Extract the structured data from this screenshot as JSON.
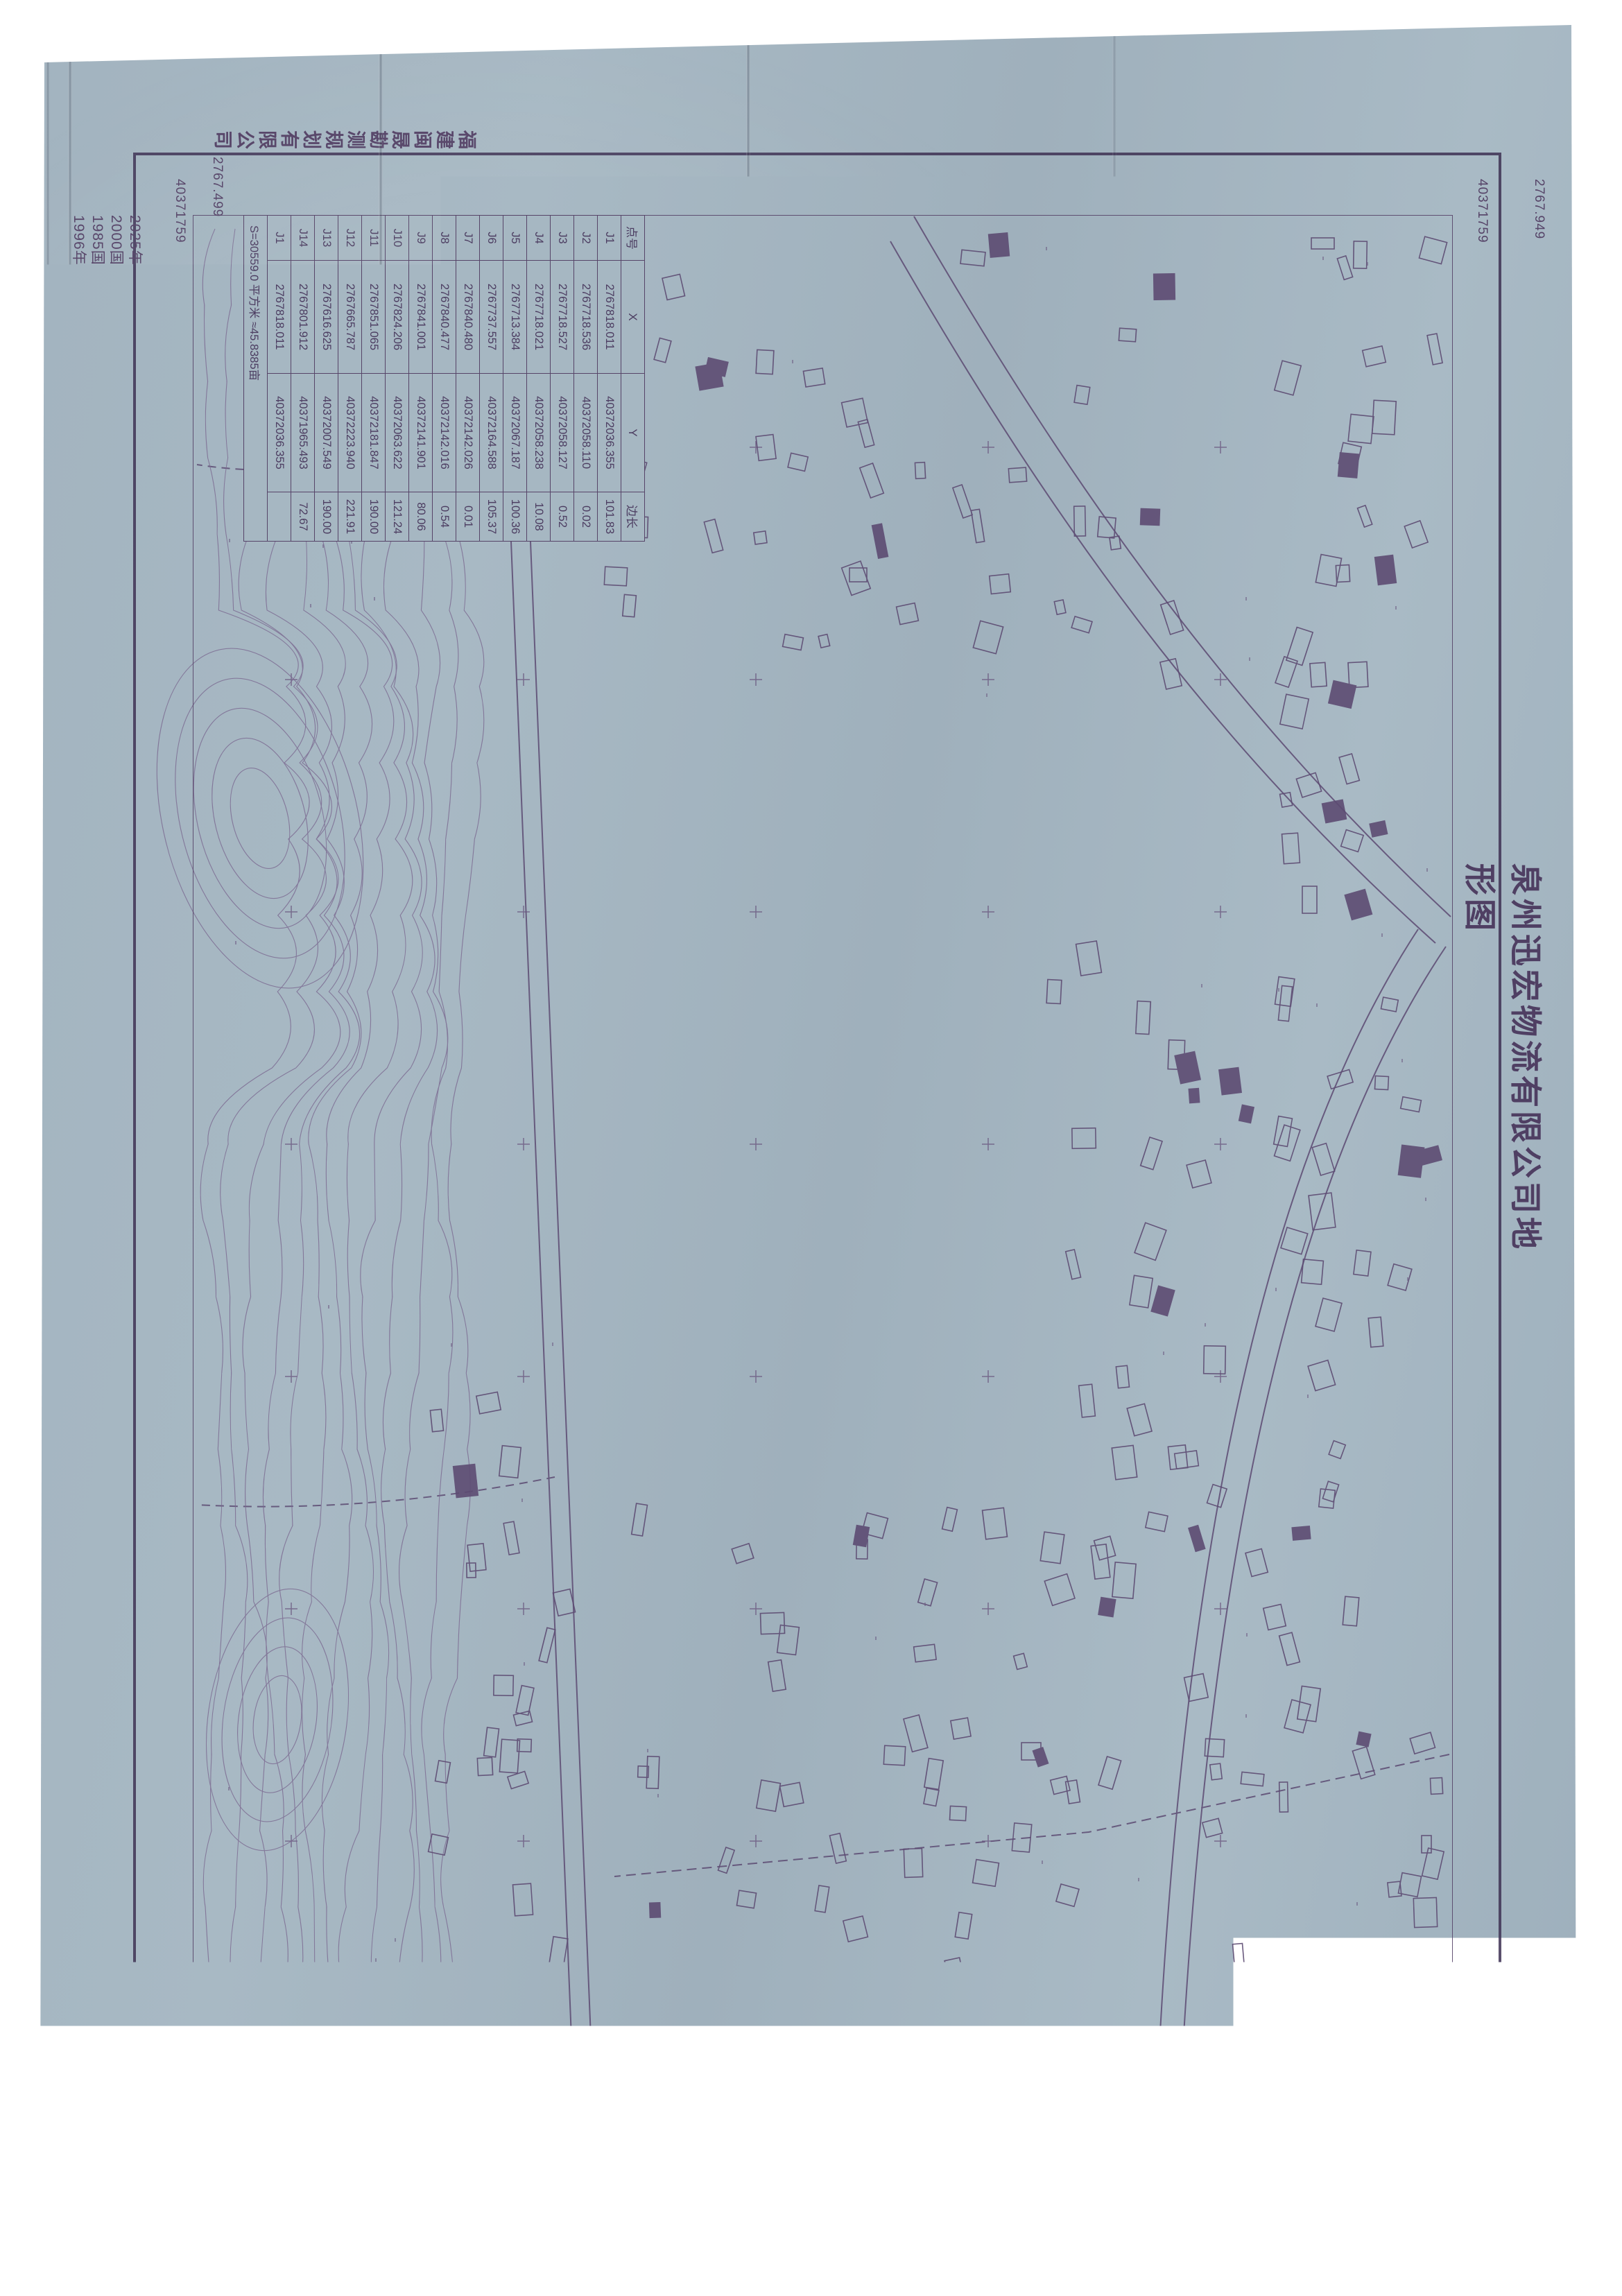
{
  "colors": {
    "paper": "#a6b7c2",
    "ink": "#564468",
    "ink_dark": "#3e3153",
    "red": "#c23a2f",
    "title": "#4f3f63",
    "watermark_text": "#16273c",
    "cs_blue": "#1f66d6"
  },
  "title": "泉州迅宏物流有限公司地形图",
  "surveyor_company": "福建闽晟勘测规划有限公司",
  "notes": [
    "2025年8月数字化制图，",
    "2000国家大地坐标系，中央子午线120度。",
    "1985国家高程基准，等高距为1.0米。",
    "1996年版图式。"
  ],
  "scale_label": "1:1500",
  "corner_labels": {
    "top_northing": "2767.949",
    "top_easting": "40371759",
    "bottom_northing": "2767.499",
    "bottom_easting": "40371759"
  },
  "road_label": "(X308)",
  "boundary_table": {
    "headers": [
      "点号",
      "X",
      "Y",
      "边长"
    ],
    "rows": [
      [
        "J1",
        "2767818.011",
        "40372036.355",
        "101.83"
      ],
      [
        "J2",
        "2767718.536",
        "40372058.110",
        "0.02"
      ],
      [
        "J3",
        "2767718.527",
        "40372058.127",
        "0.52"
      ],
      [
        "J4",
        "2767718.021",
        "40372058.238",
        "10.08"
      ],
      [
        "J5",
        "2767713.384",
        "40372067.187",
        "100.36"
      ],
      [
        "J6",
        "2767737.557",
        "40372164.588",
        "105.37"
      ],
      [
        "J7",
        "2767840.480",
        "40372142.026",
        "0.01"
      ],
      [
        "J8",
        "2767840.477",
        "40372142.016",
        "0.54"
      ],
      [
        "J9",
        "2767841.001",
        "40372141.901",
        "80.06"
      ],
      [
        "J10",
        "2767824.206",
        "40372063.622",
        "121.24"
      ],
      [
        "J11",
        "2767851.065",
        "40372181.847",
        "190.00"
      ],
      [
        "J12",
        "2767665.787",
        "40372223.940",
        "221.91"
      ],
      [
        "J13",
        "2767616.625",
        "40372007.549",
        "190.00"
      ],
      [
        "J14",
        "2767801.912",
        "40371965.493",
        "72.67"
      ],
      [
        "J1",
        "2767818.011",
        "40372036.355",
        ""
      ]
    ],
    "area_row": "S=30559.0 平方米 ≈45.8385亩"
  },
  "red_annotation": {
    "area_text": "S=30559.0 平方米 ≈45.8385亩"
  },
  "explain_box": {
    "text": "说明：红线系泉州迅宏物流有限公司规划报批用地界线。"
  },
  "stamp": {
    "ring_text": "福建闽晟勘测规划有限公司"
  },
  "watermark": {
    "logo_text": "CS",
    "app_name": "扫描全能王",
    "tagline": "3亿人都在用的扫描App"
  }
}
